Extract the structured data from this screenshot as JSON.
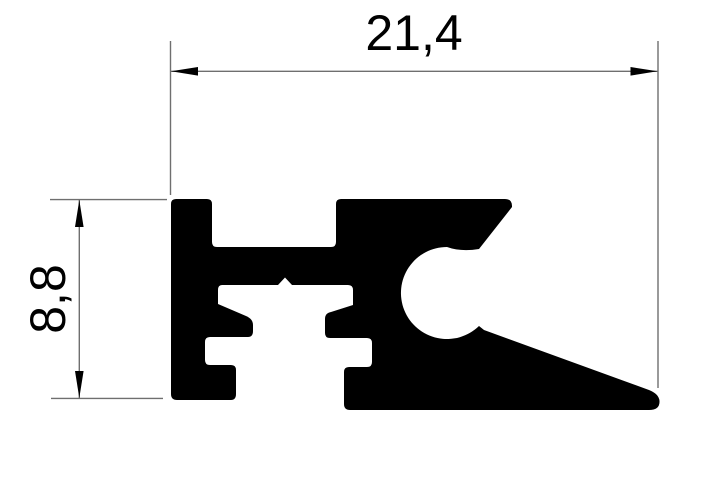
{
  "dimensions": {
    "width_label": "21,4",
    "height_label": "8,8"
  },
  "colors": {
    "background": "#ffffff",
    "profile_fill": "#000000",
    "dimension_line": "#6f6f6f",
    "arrow_fill": "#000000",
    "text": "#000000"
  },
  "geometry": {
    "profile_path": "M 171 394 L 171 204 Q 171 199 176 199 L 207 199 Q 212 199 212 204 L 212 242 Q 212 247 217 247 L 331 247 Q 336 247 336 242 L 336 204 Q 336 199 341 199 L 505 199 Q 512 199 512 206 L 512 207 L 479 249 Q 461 252 447 247 A 46 46 0 1 0 479 326 L 484 330 L 649 390 Q 659 394 659.5 401 Q 660 410 649 410 L 350 410 Q 344 410 344 404 L 344 372 Q 344 367 349 367 L 367 367 Q 372 367 372 362 L 372 343 Q 372 338 367 338 L 330 338 Q 325 338 325 333 L 325 319 Q 325 313 331 312 L 353 305 L 353 290 Q 353 285 348 285 L 292 285 L 285 277.5 L 278 285 L 222 285 Q 218 285 218 290 L 218 304 L 246 316 Q 253 319 253 325 L 253 331 Q 253 337 248 337 L 210 337 Q 205 337 205 342 L 205 360 Q 205 365 210 365 L 231 365 Q 236 365 236 370 L 236 394 Q 236 400 231 400 L 177 400 Q 171 400 171 394 Z",
    "h_dim": {
      "ext_left": "M170.5 41 V195",
      "ext_right": "M658 41 V388",
      "line": "M171 71.3 H657.5",
      "arrow_left": "M171 71.3 L198 67 L198 75.6 Z",
      "arrow_right": "M657.5 71.3 L630.5 67 L630.5 75.6 Z"
    },
    "v_dim": {
      "ext_top": "M50 199.6 H167",
      "ext_bottom": "M51 398.4 H163",
      "line": "M79.3 200 V398",
      "arrow_top": "M79.3 200 L75 227 L83.6 227 Z",
      "arrow_bottom": "M79.3 398 L75 371 L83.6 371 Z"
    }
  }
}
